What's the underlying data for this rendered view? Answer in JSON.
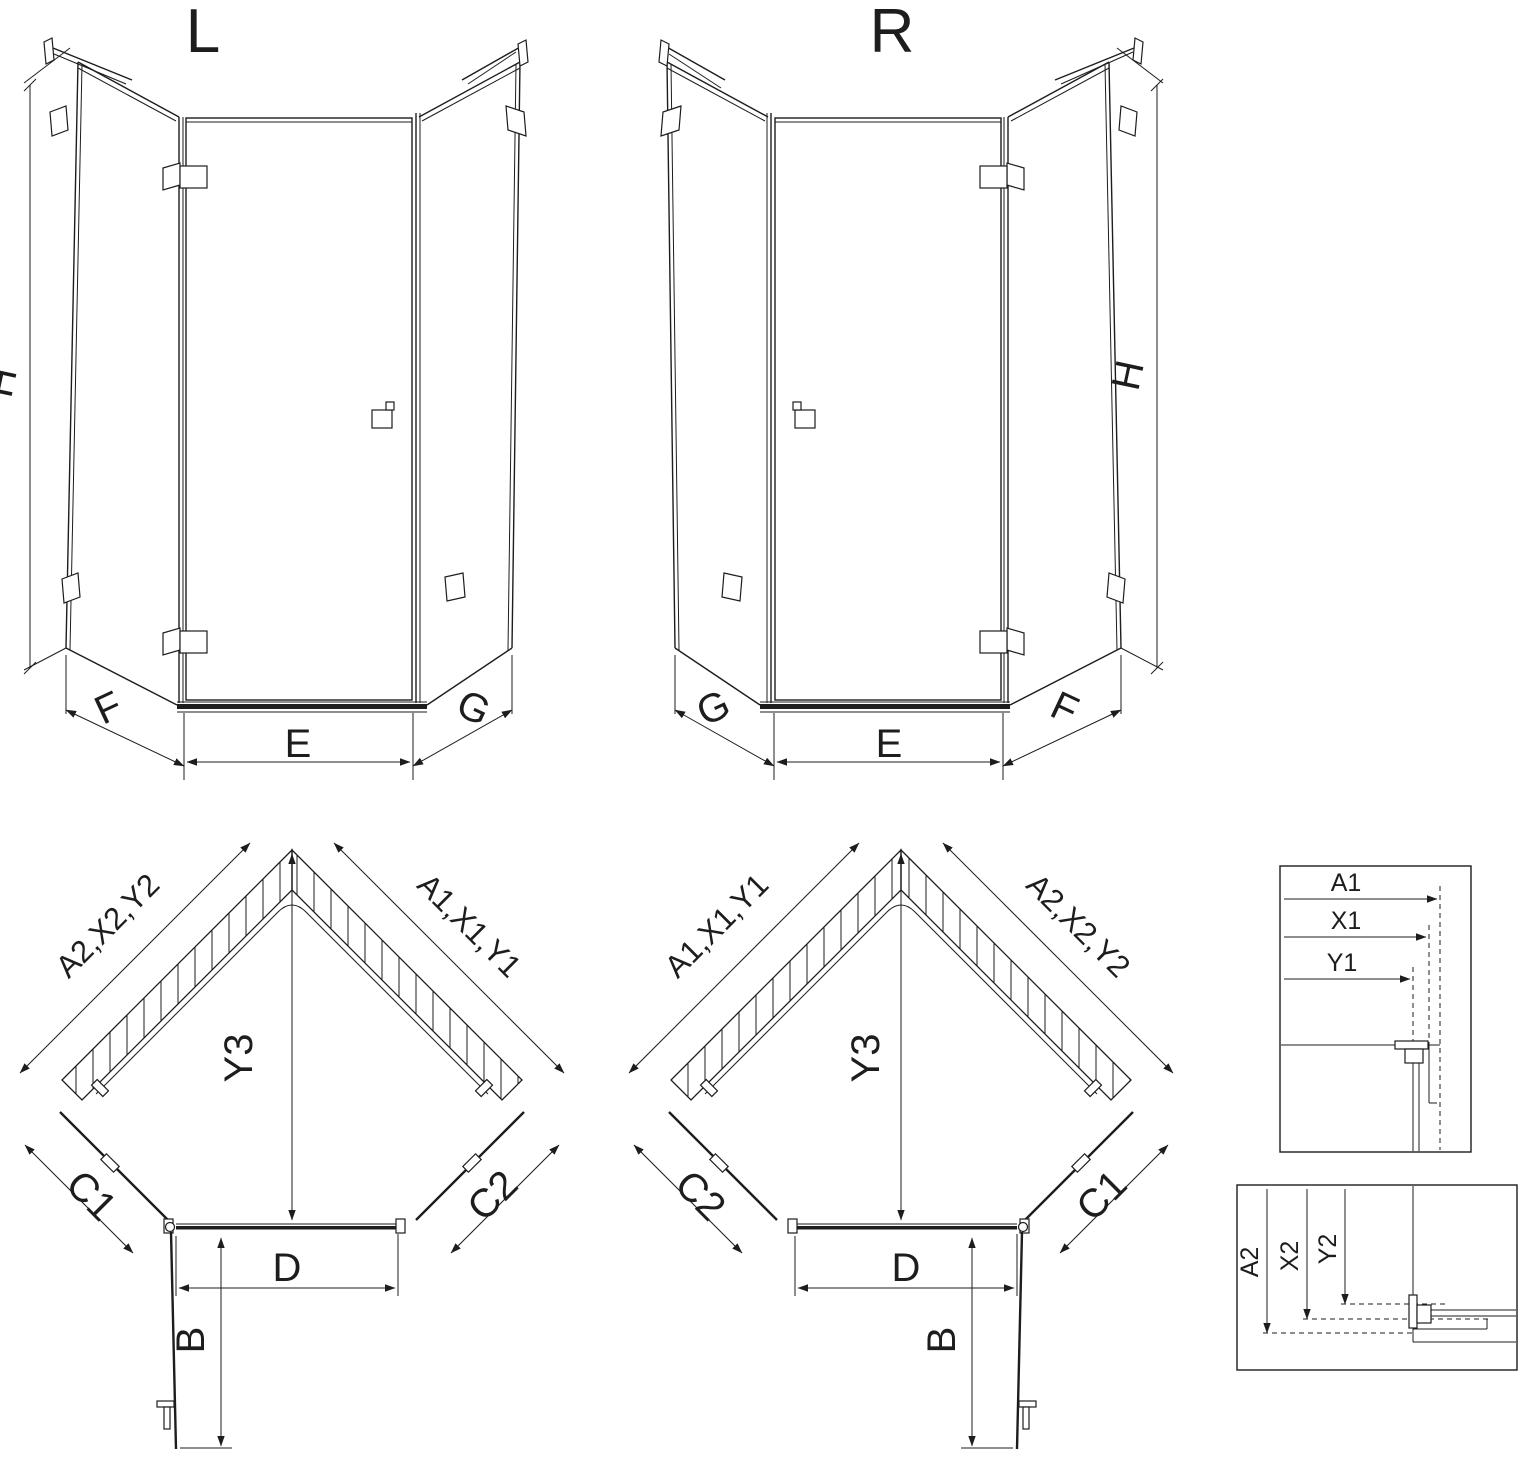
{
  "colors": {
    "line": "#1d1d1d",
    "background": "#ffffff"
  },
  "titles": {
    "left_variant": "L",
    "right_variant": "R"
  },
  "elev_l": {
    "h": "H",
    "f": "F",
    "e": "E",
    "g": "G"
  },
  "elev_r": {
    "h": "H",
    "g": "G",
    "e": "E",
    "f": "F"
  },
  "plan_l": {
    "wall_left": "A2,X2,Y2",
    "wall_right": "A1,X1,Y1",
    "depth": "Y3",
    "side_left": "C1",
    "side_right": "C2",
    "door": "D",
    "swing": "B"
  },
  "plan_r": {
    "wall_left": "A1,X1,Y1",
    "wall_right": "A2,X2,Y2",
    "depth": "Y3",
    "side_left": "C2",
    "side_right": "C1",
    "door": "D",
    "swing": "B"
  },
  "detail_top": {
    "rows": [
      "A1",
      "X1",
      "Y1"
    ]
  },
  "detail_bottom": {
    "rows": [
      "A2",
      "X2",
      "Y2"
    ]
  }
}
